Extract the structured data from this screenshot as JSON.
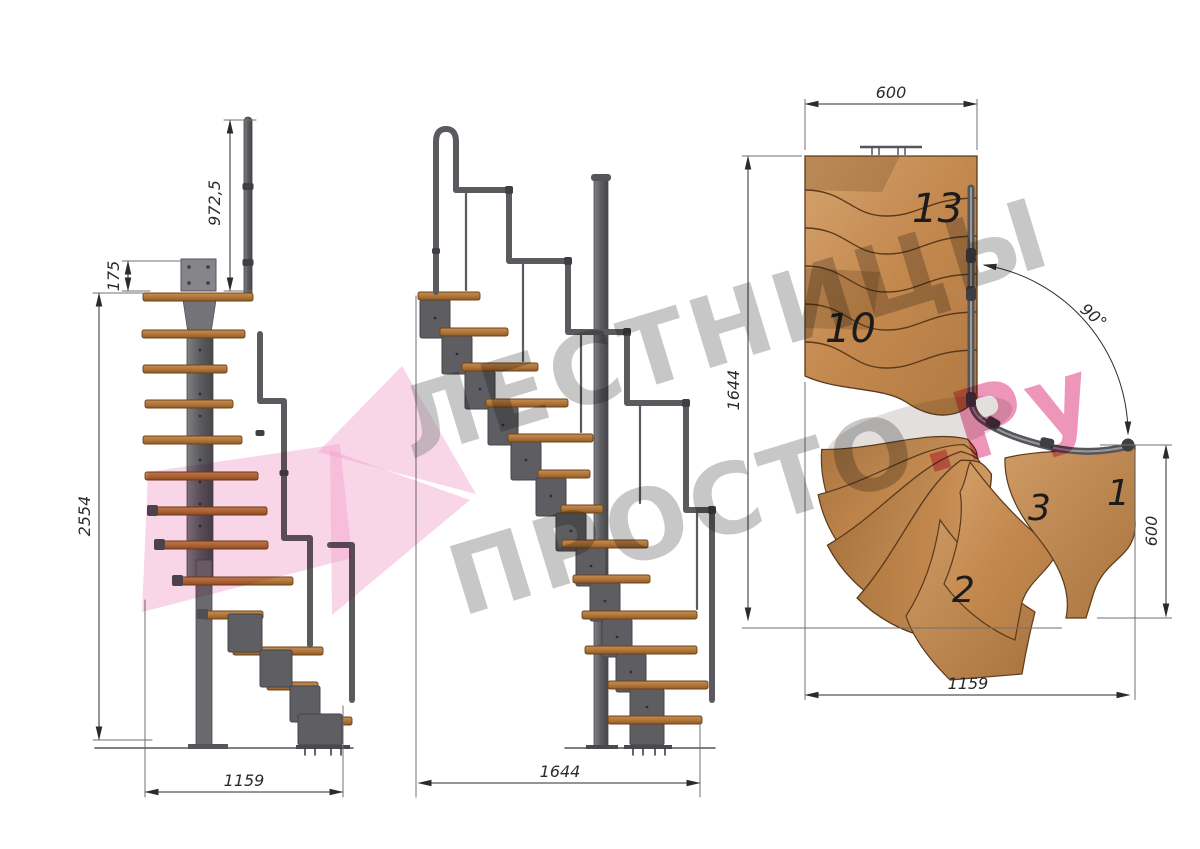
{
  "drawing": {
    "title": "modular-staircase-technical-drawing",
    "side_view": {
      "dim_handrail_height": "972,5",
      "dim_plate_height": "175",
      "dim_total_height": "2554",
      "dim_base_width": "1159"
    },
    "front_view": {
      "dim_base_width": "1644"
    },
    "plan_view": {
      "dim_top_width": "600",
      "dim_left_height": "1644",
      "dim_right_depth": "600",
      "dim_bottom_width": "1159",
      "turn_angle": "90°",
      "step_label_13": "13",
      "step_label_10": "10",
      "step_label_3": "3",
      "step_label_2": "2",
      "step_label_1": "1"
    },
    "watermark": {
      "line1": "ЛЕСТНИЦЫ",
      "line2": "ПРОСТО",
      "suffix": ".Ру"
    },
    "colors": {
      "wood_plan": "#cb965e",
      "wood_plan_dark": "#a87545",
      "wood_tread": "#b5793f",
      "steel": "#5d5d61",
      "steel_dark": "#3f3f43",
      "dim_line": "#3a3a3a",
      "watermark_gray": "#8f8f8f",
      "watermark_pink": "#f2a2cc",
      "watermark_accent": "#e4548f"
    }
  }
}
